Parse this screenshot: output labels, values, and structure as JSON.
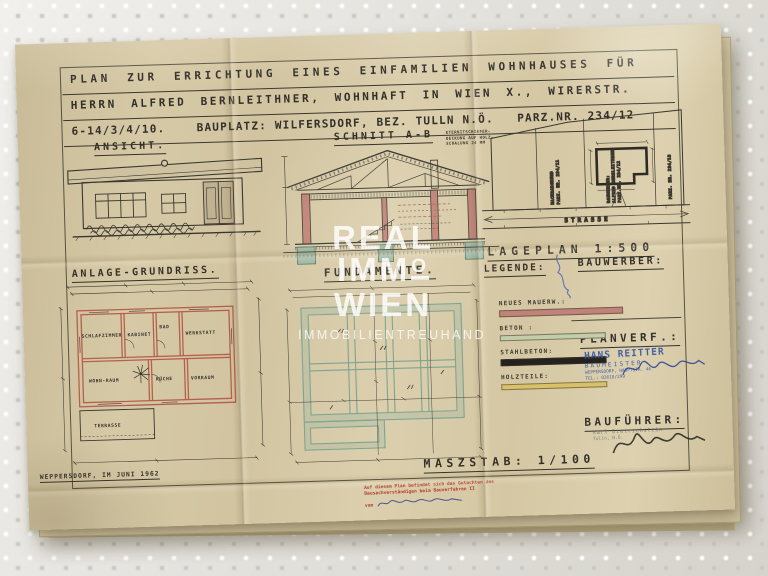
{
  "watermark": {
    "line1": "REAL",
    "line2_prefix": "IMM",
    "line2_o": "O",
    "line3": "WIEN",
    "line4": "IMMOBILIENTREUHAND"
  },
  "title_block": {
    "line1": "PLAN ZUR ERRICHTUNG EINES EINFAMILIEN WOHNHAUSES FÜR",
    "line2": "HERRN ALFRED BERNLEITHNER, WOHNHAFT IN WIEN X., WIRERSTR.",
    "line3": "6-14/3/4/10.    BAUPLATZ: WILFERSDORF, BEZ. TULLN N.Ö.   PARZ.NR. 234/12"
  },
  "ansicht": {
    "label": "ANSICHT."
  },
  "schnitt": {
    "label": "SCHNITT A-B",
    "note1": "ETERNITSCHIEFER-",
    "note2": "DECKUNG AUF HOLZ-",
    "note3": "SCHALUNG 24 MM"
  },
  "lageplan": {
    "label": "LAGEPLAN 1:500",
    "strasse": "STRASSE",
    "parcel_left_1": "NACHBARGRUND",
    "parcel_left_2": "PARZ. NR. 234/11",
    "parcel_mid_1": "BAUWERBER:",
    "parcel_mid_2": "ALFRED BERNLEITHNER",
    "parcel_mid_3": "PARZ.NR. 234/12",
    "parcel_right": "PARZ. NR. 234/13"
  },
  "grundriss": {
    "label": "ANLAGE-GRUNDRISS.",
    "rooms": {
      "schlafzimmer": "SCHLAFZIMMER",
      "kabinet": "KABINET",
      "bad": "BAD",
      "werkstatt": "WERKSTATT",
      "wohnraum": "WOHN-RAUM",
      "kueche": "KÜCHE",
      "vorraum": "VORRAUM",
      "terrasse": "TERRASSE"
    }
  },
  "fundamente": {
    "label": "FUNDAMENTE."
  },
  "legende": {
    "label": "LEGENDE:",
    "bauwerber_label": "BAUWERBER:",
    "items": [
      {
        "label": "NEUES MAUERW.:",
        "color": "#c08377"
      },
      {
        "label": "BETON :",
        "color": "#c3cda8"
      },
      {
        "label": "STAHLBETON:",
        "color": "#25221d"
      },
      {
        "label": "HOLZTEILE:",
        "color": "#d9c169"
      }
    ]
  },
  "planverf": {
    "label": "PLANVERF.:",
    "stamp": {
      "name": "HANS REITTER",
      "role": "BAUMEISTER",
      "address": "WEPPERSDORF, HAUPTSTR. 46",
      "phone": "TEL.: 02618/299"
    }
  },
  "baufuehrer": {
    "label": "BAUFÜHRER:",
    "stamp": {
      "line1": "Karl Dietrichstein",
      "line2": "Tulln, N.Ö."
    }
  },
  "footer": {
    "place_date": "WEPPERSDORF, IM JUNI 1962",
    "massstab": "MASZSTAB: 1/100",
    "red_stamp_line1": "Auf diesem Plan befindet sich das Gutachten des",
    "red_stamp_line2": "Bausachverständigen beim Bauverfahren II",
    "red_stamp_line3": "vom"
  },
  "colors": {
    "wall_red": "#b5604e",
    "foundation_teal": "#7fa492",
    "stamp_blue": "#3a57a5",
    "stamp_red": "#b23a2c",
    "paper": "#d5c7a3"
  }
}
